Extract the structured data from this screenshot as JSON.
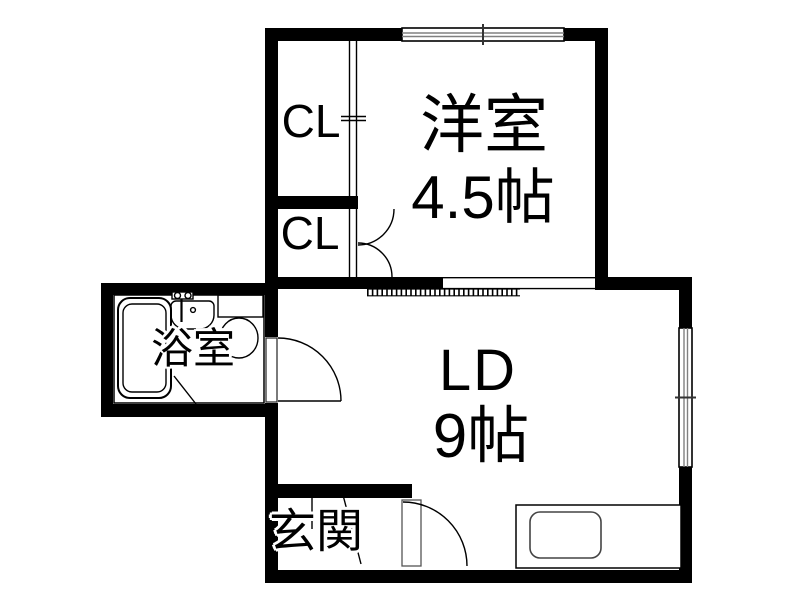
{
  "rooms": {
    "western": {
      "label": "洋室",
      "size": "4.5帖"
    },
    "living_dining": {
      "label": "LD",
      "size": "9帖"
    },
    "closet_upper": {
      "label": "CL"
    },
    "closet_lower": {
      "label": "CL"
    },
    "bathroom": {
      "label": "浴室"
    },
    "entrance": {
      "label": "玄関"
    }
  },
  "icons": {
    "bathtub": "double-rounded-rect",
    "faucet": "two-knob-mixer",
    "washbasin": "bowl-with-drain",
    "toilet": "tank-and-oval-bowl",
    "kitchen-counter": "rect",
    "kitchen-sink": "rounded-rect",
    "door-swing": "quarter-circle-arc",
    "double-door": "twin-quarter-arcs",
    "sliding-door": "double-parallel-line",
    "window": "double-line-with-center-tick",
    "hatch-strip": "ladder-dash-band"
  },
  "colors": {
    "wall": "#000000",
    "background": "#ffffff",
    "thin_line": "#000000",
    "window_inner_line": "#808080",
    "fixture_line": "#333333"
  }
}
